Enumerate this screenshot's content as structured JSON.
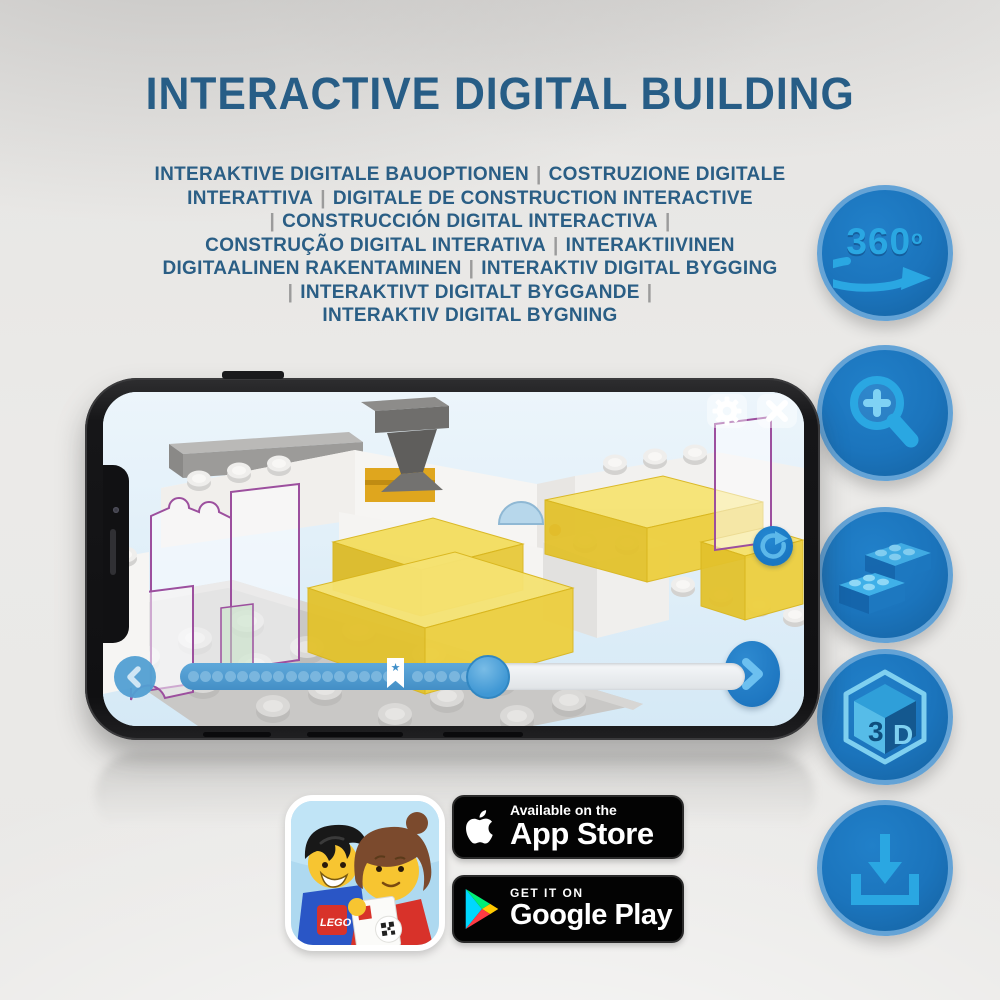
{
  "header": {
    "title": "INTERACTIVE DIGITAL BUILDING"
  },
  "subtitle": {
    "lines": [
      "INTERAKTIVE DIGITALE BAUOPTIONEN | COSTRUZIONE DIGITALE",
      "INTERATTIVA | DIGITALE DE CONSTRUCTION INTERACTIVE",
      "| CONSTRUCCIÓN DIGITAL INTERACTIVA |",
      "CONSTRUÇÃO DIGITAL INTERATIVA | INTERAKTIIVINEN",
      "DIGITAALINEN RAKENTAMINEN | INTERAKTIV DIGITAL BYGGING",
      "| INTERAKTIVT DIGITALT BYGGANDE |",
      "INTERAKTIV DIGITAL BYGNING"
    ]
  },
  "feature_icons": {
    "rotation_360": {
      "label": "360",
      "degree_mark": "o"
    },
    "three_d": {
      "left": "3",
      "right": "D"
    }
  },
  "phone_app": {
    "slider": {
      "percent_filled": 57,
      "dots_before_bookmark": 17,
      "dots_after_bookmark": 5,
      "bookmark_symbol": "★"
    }
  },
  "store_badges": {
    "lego_app_logo": "LEGO",
    "app_store": {
      "line1": "Available on the",
      "line2": "App Store"
    },
    "google_play": {
      "line1": "GET IT ON",
      "line2": "Google Play"
    }
  },
  "colors": {
    "heading_blue": "#275d86",
    "separator_gray": "#9b9b9b",
    "icon_circle_blue": "#1b74bc",
    "icon_glyph_blue": "#2aa7e2",
    "app_accent_blue": "#2f8ccc",
    "lego_yellow": "#f0d43c",
    "ghost_outline_purple": "#9c4f9e"
  }
}
